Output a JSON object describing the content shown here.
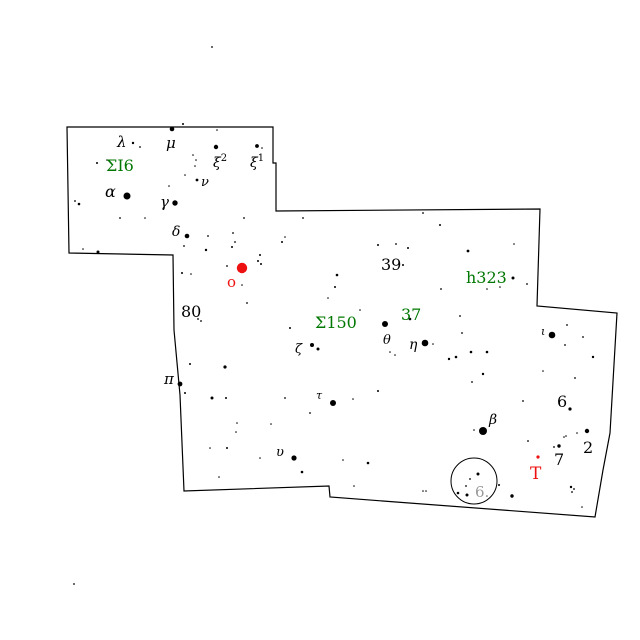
{
  "map": {
    "type": "star-finder-chart",
    "background": "#ffffff",
    "colors": {
      "black": "#000000",
      "green": "#007700",
      "red": "#ee1111",
      "grey": "#999999",
      "boundary": "#000000",
      "star": "#000000"
    },
    "boundary_points": [
      [
        67,
        127
      ],
      [
        273,
        127
      ],
      [
        273,
        163
      ],
      [
        276,
        163
      ],
      [
        276,
        211
      ],
      [
        540,
        209
      ],
      [
        537,
        306
      ],
      [
        617,
        313
      ],
      [
        610,
        433
      ],
      [
        603,
        470
      ],
      [
        595,
        517
      ],
      [
        330,
        497
      ],
      [
        329,
        486
      ],
      [
        184,
        491
      ],
      [
        180,
        395
      ],
      [
        174,
        330
      ],
      [
        173,
        255
      ],
      [
        69,
        253
      ]
    ],
    "highlight_circle": {
      "cx": 474,
      "cy": 481,
      "r": 23,
      "label": "6.",
      "label_x": 475,
      "label_y": 497,
      "label_size": 15,
      "label_color": "grey"
    },
    "variable_stars": [
      {
        "name": "omicron-variable",
        "x": 242,
        "y": 268,
        "r": 5.2
      },
      {
        "name": "T-variable",
        "x": 538,
        "y": 457,
        "r": 1.6
      }
    ],
    "labels": [
      {
        "text": "λ",
        "x": 117,
        "y": 147,
        "size": 15,
        "color": "black",
        "italic": true
      },
      {
        "text": "μ",
        "x": 166,
        "y": 148,
        "size": 15,
        "color": "black",
        "italic": true
      },
      {
        "text": "ξ",
        "sup": "2",
        "x": 213,
        "y": 167,
        "size": 14,
        "color": "black",
        "italic": true
      },
      {
        "text": "ξ",
        "sup": "1",
        "x": 250,
        "y": 167,
        "size": 14,
        "color": "black",
        "italic": true
      },
      {
        "text": "ν",
        "x": 201,
        "y": 186,
        "size": 13,
        "color": "black",
        "italic": true
      },
      {
        "text": "α",
        "x": 105,
        "y": 197,
        "size": 16,
        "color": "black",
        "italic": true
      },
      {
        "text": "γ",
        "x": 160,
        "y": 207,
        "size": 15,
        "color": "black",
        "italic": true
      },
      {
        "text": "δ",
        "x": 172,
        "y": 236,
        "size": 14,
        "color": "black",
        "italic": true
      },
      {
        "text": "80",
        "x": 181,
        "y": 317,
        "size": 16,
        "color": "black"
      },
      {
        "text": "39",
        "x": 381,
        "y": 270,
        "size": 16,
        "color": "black"
      },
      {
        "text": "θ",
        "x": 383,
        "y": 344,
        "size": 13,
        "color": "black",
        "italic": true
      },
      {
        "text": "η",
        "x": 409,
        "y": 349,
        "size": 14,
        "color": "black",
        "italic": true
      },
      {
        "text": "ζ",
        "x": 295,
        "y": 353,
        "size": 13,
        "color": "black",
        "italic": true
      },
      {
        "text": "π",
        "x": 164,
        "y": 384,
        "size": 15,
        "color": "black",
        "italic": true
      },
      {
        "text": "τ",
        "x": 316,
        "y": 399,
        "size": 11,
        "color": "black",
        "italic": true
      },
      {
        "text": "υ",
        "x": 276,
        "y": 456,
        "size": 13,
        "color": "black",
        "italic": true
      },
      {
        "text": "β",
        "x": 489,
        "y": 424,
        "size": 14,
        "color": "black",
        "italic": true
      },
      {
        "text": "ι",
        "x": 541,
        "y": 335,
        "size": 11,
        "color": "black",
        "italic": true
      },
      {
        "text": "6",
        "x": 557,
        "y": 407,
        "size": 16,
        "color": "black"
      },
      {
        "text": "2",
        "x": 583,
        "y": 453,
        "size": 16,
        "color": "black"
      },
      {
        "text": "7",
        "x": 554,
        "y": 465,
        "size": 16,
        "color": "black"
      },
      {
        "text": "ΣI6",
        "x": 106,
        "y": 171,
        "size": 16,
        "color": "green"
      },
      {
        "text": "Σ150",
        "x": 315,
        "y": 328,
        "size": 16,
        "color": "green"
      },
      {
        "text": "37",
        "x": 401,
        "y": 320,
        "size": 16,
        "color": "green"
      },
      {
        "text": "h323",
        "x": 466,
        "y": 283,
        "size": 16,
        "color": "green"
      },
      {
        "text": "o",
        "x": 227,
        "y": 287,
        "size": 15,
        "color": "red"
      },
      {
        "text": "T",
        "x": 530,
        "y": 479,
        "size": 17,
        "color": "red"
      },
      {
        "text": "6.",
        "x": 475,
        "y": 497,
        "size": 15,
        "color": "grey"
      }
    ],
    "stars": [
      [
        172,
        129,
        2.3
      ],
      [
        216,
        147,
        2.2
      ],
      [
        257,
        146,
        1.9
      ],
      [
        133,
        143,
        1.2
      ],
      [
        127,
        196,
        3.5
      ],
      [
        175,
        203,
        2.7
      ],
      [
        187,
        236,
        2.3
      ],
      [
        197,
        180,
        1.4
      ],
      [
        180,
        384,
        2.4
      ],
      [
        333,
        403,
        3
      ],
      [
        294,
        458,
        2.6
      ],
      [
        312,
        345,
        2
      ],
      [
        318,
        349,
        1.5
      ],
      [
        385,
        324,
        3
      ],
      [
        425,
        343,
        3.3
      ],
      [
        483,
        431,
        4
      ],
      [
        552,
        335,
        3.3
      ],
      [
        410,
        319,
        1.3
      ],
      [
        403,
        265,
        1
      ],
      [
        513,
        278,
        1.5
      ],
      [
        570,
        409,
        1.6
      ],
      [
        587,
        431,
        2.2
      ],
      [
        559,
        446,
        1.7
      ],
      [
        554,
        447,
        0.9
      ],
      [
        198,
        319,
        0.9
      ],
      [
        201,
        321,
        0.9
      ],
      [
        212,
        47,
        0.9
      ],
      [
        74,
        584,
        0.9
      ],
      [
        183,
        124,
        1
      ],
      [
        140,
        147,
        0.9
      ],
      [
        217,
        130,
        0.8
      ],
      [
        262,
        148,
        0.8
      ],
      [
        193,
        155,
        0.8
      ],
      [
        196,
        160,
        0.8
      ],
      [
        195,
        166,
        0.8
      ],
      [
        185,
        175,
        0.8
      ],
      [
        169,
        186,
        0.8
      ],
      [
        97,
        163,
        1
      ],
      [
        107,
        160,
        0.8
      ],
      [
        79,
        204,
        1.3
      ],
      [
        75,
        201,
        0.9
      ],
      [
        120,
        218,
        0.9
      ],
      [
        145,
        218,
        0.8
      ],
      [
        98,
        252,
        1.5
      ],
      [
        83,
        249,
        0.8
      ],
      [
        184,
        246,
        0.9
      ],
      [
        244,
        218,
        0.9
      ],
      [
        208,
        236,
        0.9
      ],
      [
        233,
        233,
        0.9
      ],
      [
        235,
        242,
        0.9
      ],
      [
        182,
        273,
        1
      ],
      [
        191,
        274,
        0.8
      ],
      [
        303,
        218,
        0.9
      ],
      [
        423,
        213,
        0.9
      ],
      [
        440,
        225,
        1
      ],
      [
        282,
        242,
        1
      ],
      [
        285,
        237,
        0.8
      ],
      [
        378,
        245,
        1
      ],
      [
        396,
        244,
        0.9
      ],
      [
        408,
        248,
        1
      ],
      [
        468,
        251,
        1.4
      ],
      [
        514,
        244,
        0.8
      ],
      [
        527,
        284,
        0.9
      ],
      [
        500,
        287,
        0.8
      ],
      [
        487,
        289,
        0.8
      ],
      [
        441,
        289,
        0.9
      ],
      [
        460,
        316,
        0.9
      ],
      [
        462,
        333,
        0.9
      ],
      [
        206,
        250,
        1.2
      ],
      [
        232,
        247,
        1
      ],
      [
        260,
        255,
        1
      ],
      [
        261,
        264,
        1
      ],
      [
        227,
        266,
        0.9
      ],
      [
        258,
        261,
        1
      ],
      [
        247,
        303,
        0.9
      ],
      [
        290,
        328,
        1
      ],
      [
        337,
        275,
        1.3
      ],
      [
        335,
        287,
        1
      ],
      [
        328,
        298,
        0.8
      ],
      [
        360,
        310,
        0.8
      ],
      [
        242,
        285,
        0.8
      ],
      [
        190,
        364,
        1
      ],
      [
        225,
        367,
        1.6
      ],
      [
        185,
        393,
        1
      ],
      [
        212,
        398,
        1.5
      ],
      [
        226,
        398,
        1
      ],
      [
        285,
        398,
        0.9
      ],
      [
        353,
        399,
        0.8
      ],
      [
        378,
        391,
        1
      ],
      [
        310,
        413,
        0.9
      ],
      [
        237,
        423,
        0.8
      ],
      [
        236,
        432,
        0.8
      ],
      [
        271,
        424,
        0.8
      ],
      [
        210,
        448,
        0.8
      ],
      [
        227,
        448,
        1
      ],
      [
        260,
        458,
        0.8
      ],
      [
        302,
        472,
        1.3
      ],
      [
        343,
        460,
        0.8
      ],
      [
        368,
        463,
        1.3
      ],
      [
        354,
        486,
        0.8
      ],
      [
        219,
        477,
        0.8
      ],
      [
        395,
        355,
        0.8
      ],
      [
        449,
        359,
        1.2
      ],
      [
        456,
        357,
        1.3
      ],
      [
        471,
        352,
        1.3
      ],
      [
        487,
        352,
        1.3
      ],
      [
        483,
        374,
        1.2
      ],
      [
        472,
        382,
        0.9
      ],
      [
        543,
        371,
        0.8
      ],
      [
        523,
        401,
        0.9
      ],
      [
        433,
        344,
        0.8
      ],
      [
        474,
        430,
        0.8
      ],
      [
        528,
        441,
        0.9
      ],
      [
        567,
        325,
        0.9
      ],
      [
        583,
        337,
        0.9
      ],
      [
        565,
        345,
        0.9
      ],
      [
        593,
        357,
        1.2
      ],
      [
        575,
        378,
        0.9
      ],
      [
        564,
        437,
        0.8
      ],
      [
        577,
        433,
        0.8
      ],
      [
        566,
        436,
        0.8
      ],
      [
        512,
        496,
        1.7
      ],
      [
        478,
        474,
        1.5
      ],
      [
        470,
        479,
        0.9
      ],
      [
        466,
        486,
        0.9
      ],
      [
        458,
        493,
        1.3
      ],
      [
        467,
        495,
        1.5
      ],
      [
        499,
        485,
        1
      ],
      [
        572,
        492,
        0.9
      ],
      [
        582,
        507,
        0.8
      ],
      [
        571,
        487,
        1.2
      ],
      [
        574,
        489,
        0.9
      ],
      [
        423,
        491,
        0.8
      ],
      [
        426,
        491,
        0.8
      ],
      [
        390,
        352,
        0.8
      ]
    ]
  }
}
